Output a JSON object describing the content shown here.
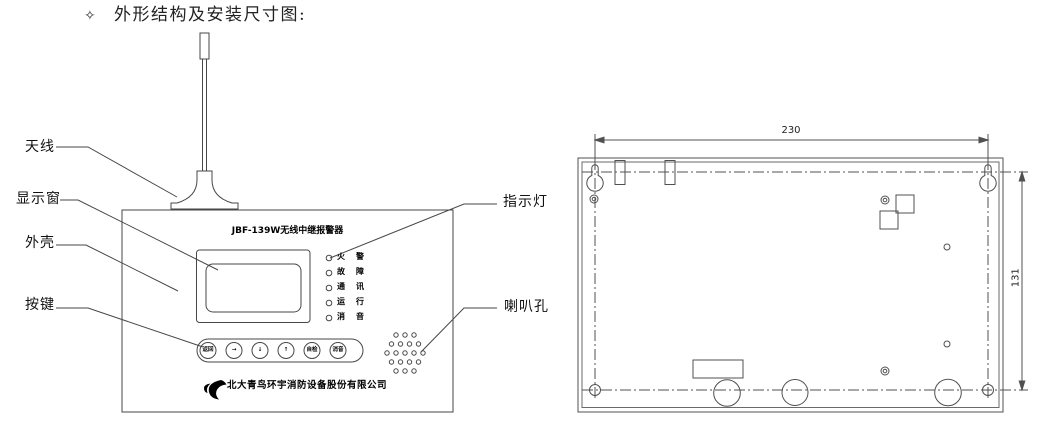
{
  "header": {
    "bullet": "✧",
    "title": "外形结构及安装尺寸图:"
  },
  "front_view": {
    "callouts": [
      {
        "label": "天线"
      },
      {
        "label": "显示窗"
      },
      {
        "label": "外壳"
      },
      {
        "label": "按键"
      },
      {
        "label": "指示灯"
      },
      {
        "label": "喇叭孔"
      }
    ],
    "device_title": "JBF-139W无线中继报警器",
    "indicators": [
      {
        "label": "火警"
      },
      {
        "label": "故障"
      },
      {
        "label": "通讯"
      },
      {
        "label": "运行"
      },
      {
        "label": "消音"
      }
    ],
    "buttons": [
      {
        "label": "返回"
      },
      {
        "label": "→"
      },
      {
        "label": "↓"
      },
      {
        "label": "↑"
      },
      {
        "label": "自检"
      },
      {
        "label": "消音"
      }
    ],
    "company": "北大青鸟环宇消防设备股份有限公司"
  },
  "rear_view": {
    "width_mm": "230",
    "height_mm": "131"
  },
  "colors": {
    "line": "#474747",
    "text": "#1c1c1c",
    "background": "#ffffff"
  }
}
